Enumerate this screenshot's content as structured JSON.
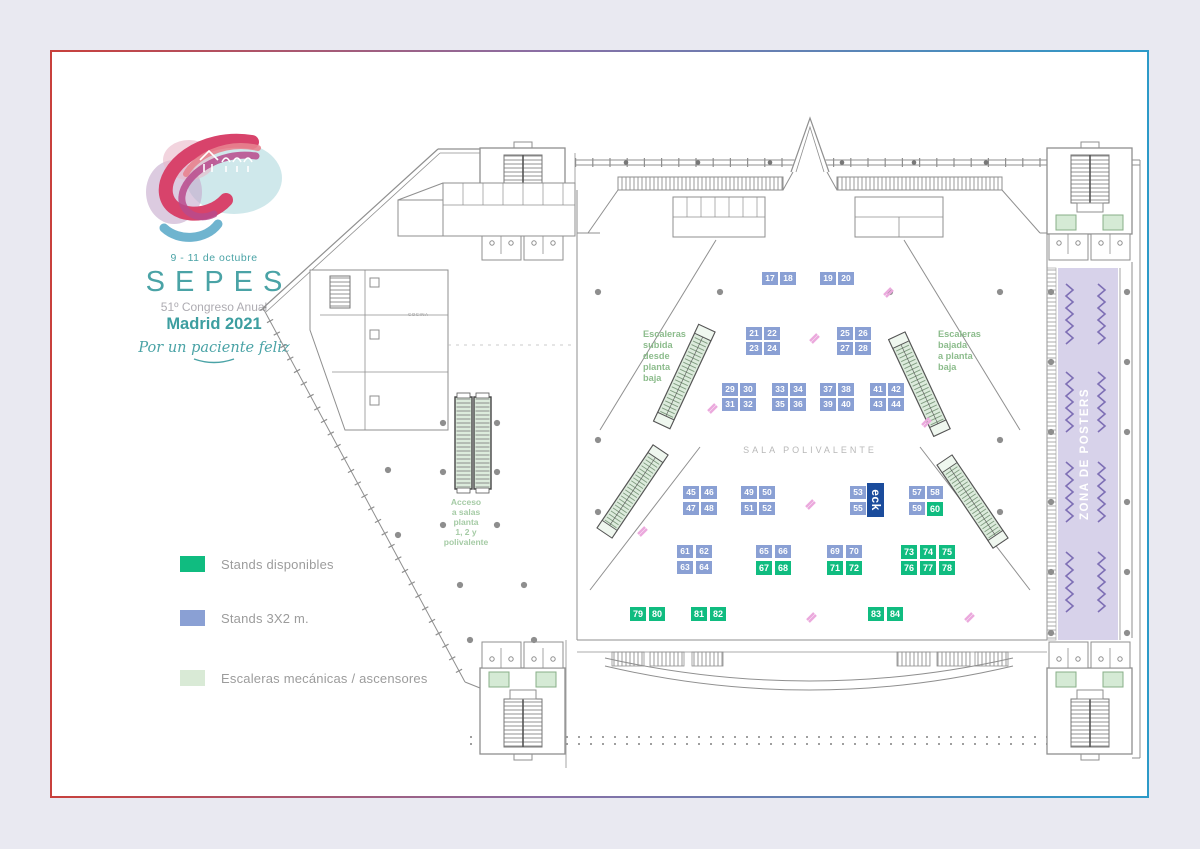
{
  "logo": {
    "dates": "9 - 11 de octubre",
    "name": "SEPES",
    "congress": "51º Congreso Anual",
    "city": "Madrid 2021",
    "tagline": "Por un paciente feliz"
  },
  "legend": {
    "items": [
      {
        "label": "Stands disponibles",
        "color": "#10BC80"
      },
      {
        "label": "Stands 3X2 m.",
        "color": "#8AA0D4"
      },
      {
        "label": "Escaleras mecánicas / ascensores",
        "color": "#D9EAD6"
      }
    ]
  },
  "plan": {
    "labels": {
      "sala": "SALA POLIVALENTE",
      "zona_posters": "ZONA DE POSTERS",
      "cocina": "COCINA",
      "subida": [
        "Escaleras",
        "subida",
        "desde",
        "planta",
        "baja"
      ],
      "bajada": [
        "Escaleras",
        "bajada",
        "a planta",
        "baja"
      ],
      "acceso": [
        "Acceso",
        "a salas",
        "planta",
        "1, 2 y",
        "polivalente"
      ]
    },
    "eck": {
      "label": "eck",
      "color": "#1B4C9C"
    },
    "stand_colors": {
      "b": "#8AA0D4",
      "g": "#10BC80"
    },
    "stands": [
      {
        "n": 17,
        "x": 762,
        "y": 272,
        "t": "b"
      },
      {
        "n": 18,
        "x": 780,
        "y": 272,
        "t": "b"
      },
      {
        "n": 19,
        "x": 820,
        "y": 272,
        "t": "b"
      },
      {
        "n": 20,
        "x": 838,
        "y": 272,
        "t": "b"
      },
      {
        "n": 21,
        "x": 746,
        "y": 327,
        "t": "b"
      },
      {
        "n": 22,
        "x": 764,
        "y": 327,
        "t": "b"
      },
      {
        "n": 23,
        "x": 746,
        "y": 342,
        "t": "b"
      },
      {
        "n": 24,
        "x": 764,
        "y": 342,
        "t": "b"
      },
      {
        "n": 25,
        "x": 837,
        "y": 327,
        "t": "b"
      },
      {
        "n": 26,
        "x": 855,
        "y": 327,
        "t": "b"
      },
      {
        "n": 27,
        "x": 837,
        "y": 342,
        "t": "b"
      },
      {
        "n": 28,
        "x": 855,
        "y": 342,
        "t": "b"
      },
      {
        "n": 29,
        "x": 722,
        "y": 383,
        "t": "b"
      },
      {
        "n": 30,
        "x": 740,
        "y": 383,
        "t": "b"
      },
      {
        "n": 31,
        "x": 722,
        "y": 398,
        "t": "b"
      },
      {
        "n": 32,
        "x": 740,
        "y": 398,
        "t": "b"
      },
      {
        "n": 33,
        "x": 772,
        "y": 383,
        "t": "b"
      },
      {
        "n": 34,
        "x": 790,
        "y": 383,
        "t": "b"
      },
      {
        "n": 35,
        "x": 772,
        "y": 398,
        "t": "b"
      },
      {
        "n": 36,
        "x": 790,
        "y": 398,
        "t": "b"
      },
      {
        "n": 37,
        "x": 820,
        "y": 383,
        "t": "b"
      },
      {
        "n": 38,
        "x": 838,
        "y": 383,
        "t": "b"
      },
      {
        "n": 39,
        "x": 820,
        "y": 398,
        "t": "b"
      },
      {
        "n": 40,
        "x": 838,
        "y": 398,
        "t": "b"
      },
      {
        "n": 41,
        "x": 870,
        "y": 383,
        "t": "b"
      },
      {
        "n": 42,
        "x": 888,
        "y": 383,
        "t": "b"
      },
      {
        "n": 43,
        "x": 870,
        "y": 398,
        "t": "b"
      },
      {
        "n": 44,
        "x": 888,
        "y": 398,
        "t": "b"
      },
      {
        "n": 45,
        "x": 683,
        "y": 486,
        "t": "b"
      },
      {
        "n": 46,
        "x": 701,
        "y": 486,
        "t": "b"
      },
      {
        "n": 47,
        "x": 683,
        "y": 502,
        "t": "b"
      },
      {
        "n": 48,
        "x": 701,
        "y": 502,
        "t": "b"
      },
      {
        "n": 49,
        "x": 741,
        "y": 486,
        "t": "b"
      },
      {
        "n": 50,
        "x": 759,
        "y": 486,
        "t": "b"
      },
      {
        "n": 51,
        "x": 741,
        "y": 502,
        "t": "b"
      },
      {
        "n": 52,
        "x": 759,
        "y": 502,
        "t": "b"
      },
      {
        "n": 53,
        "x": 850,
        "y": 486,
        "t": "b"
      },
      {
        "n": 55,
        "x": 850,
        "y": 502,
        "t": "b"
      },
      {
        "n": 57,
        "x": 909,
        "y": 486,
        "t": "b"
      },
      {
        "n": 58,
        "x": 927,
        "y": 486,
        "t": "b"
      },
      {
        "n": 59,
        "x": 909,
        "y": 502,
        "t": "b"
      },
      {
        "n": 60,
        "x": 927,
        "y": 502,
        "t": "g"
      },
      {
        "n": 61,
        "x": 677,
        "y": 545,
        "t": "b"
      },
      {
        "n": 62,
        "x": 696,
        "y": 545,
        "t": "b"
      },
      {
        "n": 63,
        "x": 677,
        "y": 561,
        "t": "b"
      },
      {
        "n": 64,
        "x": 696,
        "y": 561,
        "t": "b"
      },
      {
        "n": 65,
        "x": 756,
        "y": 545,
        "t": "b"
      },
      {
        "n": 66,
        "x": 775,
        "y": 545,
        "t": "b"
      },
      {
        "n": 67,
        "x": 756,
        "y": 561,
        "t": "g"
      },
      {
        "n": 68,
        "x": 775,
        "y": 561,
        "t": "g"
      },
      {
        "n": 69,
        "x": 827,
        "y": 545,
        "t": "b"
      },
      {
        "n": 70,
        "x": 846,
        "y": 545,
        "t": "b"
      },
      {
        "n": 71,
        "x": 827,
        "y": 561,
        "t": "g"
      },
      {
        "n": 72,
        "x": 846,
        "y": 561,
        "t": "g"
      },
      {
        "n": 73,
        "x": 901,
        "y": 545,
        "t": "g"
      },
      {
        "n": 74,
        "x": 920,
        "y": 545,
        "t": "g"
      },
      {
        "n": 75,
        "x": 939,
        "y": 545,
        "t": "g"
      },
      {
        "n": 76,
        "x": 901,
        "y": 561,
        "t": "g"
      },
      {
        "n": 77,
        "x": 920,
        "y": 561,
        "t": "g"
      },
      {
        "n": 78,
        "x": 939,
        "y": 561,
        "t": "g"
      },
      {
        "n": 79,
        "x": 630,
        "y": 607,
        "t": "g"
      },
      {
        "n": 80,
        "x": 649,
        "y": 607,
        "t": "g"
      },
      {
        "n": 81,
        "x": 691,
        "y": 607,
        "t": "g"
      },
      {
        "n": 82,
        "x": 710,
        "y": 607,
        "t": "g"
      },
      {
        "n": 83,
        "x": 868,
        "y": 607,
        "t": "g"
      },
      {
        "n": 84,
        "x": 887,
        "y": 607,
        "t": "g"
      }
    ]
  },
  "colors": {
    "page_bg": "#E9E9F1",
    "card_bg": "#FFFFFF",
    "border_red": "#C8403C",
    "border_blue": "#2C9AC8",
    "plan_line": "#8F8F8F",
    "label_green": "#8CBC8C",
    "posters_bg": "#D7D2EA",
    "posters_zigzag": "#7E6FB5",
    "escalator_fill": "#DCEBDC",
    "pink_marker": "#EBA9DD",
    "title_teal": "#4AA3A6"
  }
}
